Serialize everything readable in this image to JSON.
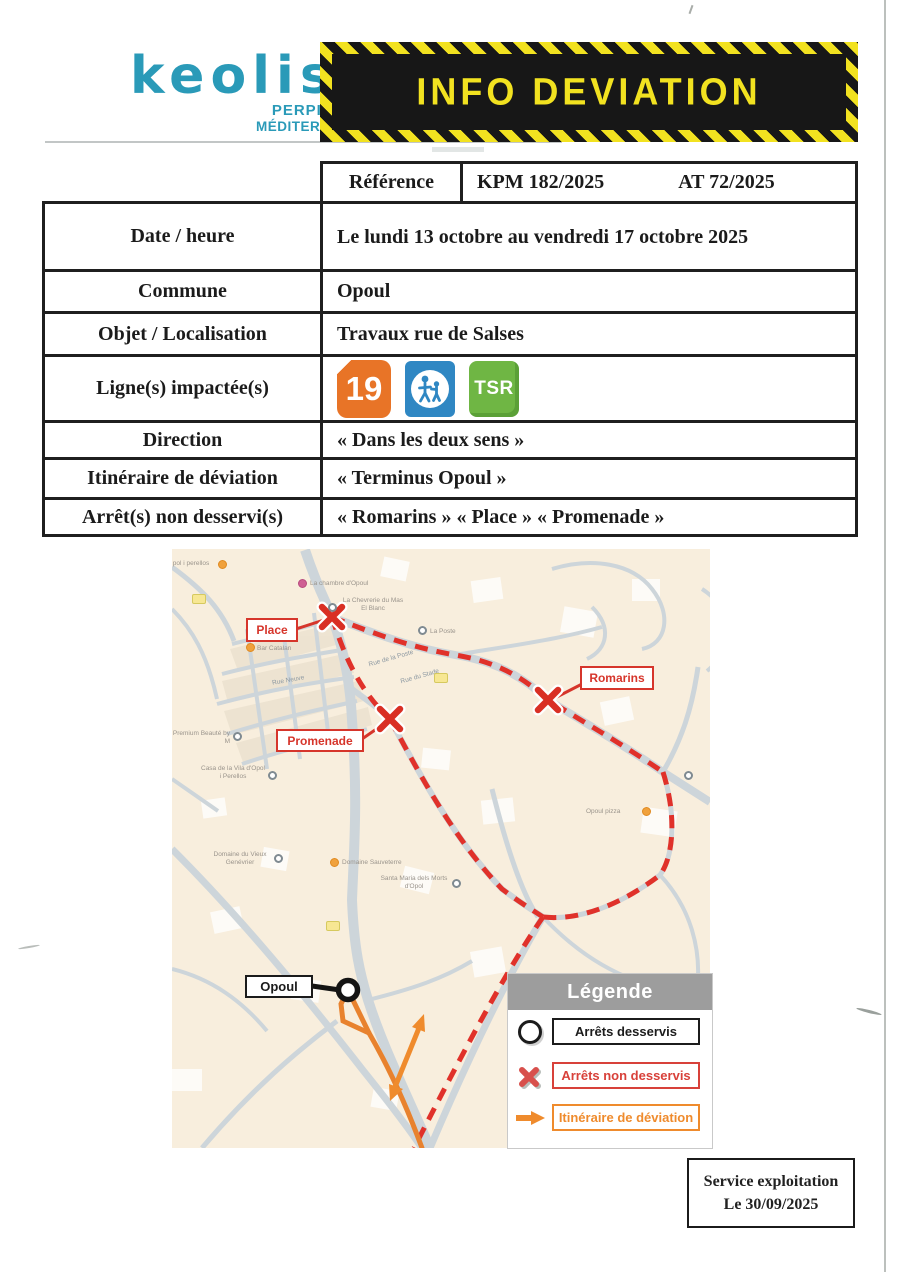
{
  "header": {
    "brand": "keolis",
    "brand_sub1": "PERPIGNAN",
    "brand_sub2": "MÉDITERRANÉE",
    "banner_title": "INFO DEVIATION",
    "banner_yellow": "#f2e220",
    "banner_black": "#171717"
  },
  "info_table": {
    "reference": {
      "label": "Référence",
      "value_left": "KPM 182/2025",
      "value_right": "AT 72/2025"
    },
    "date": {
      "label": "Date / heure",
      "value": "Le lundi 13 octobre au vendredi 17 octobre 2025",
      "color": "#e8241c"
    },
    "commune": {
      "label": "Commune",
      "value": "Opoul"
    },
    "objet": {
      "label": "Objet / Localisation",
      "value": "Travaux rue de Salses"
    },
    "lignes": {
      "label": "Ligne(s) impactée(s)"
    },
    "direction": {
      "label": "Direction",
      "value": "« Dans les deux sens »"
    },
    "itineraire": {
      "label": "Itinéraire de déviation",
      "value": "« Terminus Opoul »"
    },
    "arrets": {
      "label": "Arrêt(s) non desservi(s)",
      "value": "« Romarins » « Place » « Promenade »"
    },
    "line_badges": [
      {
        "id": "line-19",
        "text": "19",
        "color": "#e87427"
      },
      {
        "id": "line-scolaire",
        "icon": "school-children-icon",
        "color": "#2f87c3"
      },
      {
        "id": "line-tsr",
        "text": "TSR",
        "color": "#6fb644"
      }
    ]
  },
  "map": {
    "stop_labels": [
      {
        "name": "Place",
        "status": "non desservi"
      },
      {
        "name": "Promenade",
        "status": "non desservi"
      },
      {
        "name": "Romarins",
        "status": "non desservi"
      },
      {
        "name": "Opoul",
        "status": "desservi"
      }
    ],
    "streets": [
      "Rue Neuve",
      "Rue de la Poste",
      "Rue du Stade"
    ],
    "pois": [
      {
        "name": "pol i perellos"
      },
      {
        "name": "La chambre d'Opoul"
      },
      {
        "name": "La Chevrerie du Mas El Blanc"
      },
      {
        "name": "La Poste"
      },
      {
        "name": "Bar Catalan"
      },
      {
        "name": "Premium Beauté by M"
      },
      {
        "name": "Casa de la Vila d'Opol i Perellos"
      },
      {
        "name": "Opoul pizza"
      },
      {
        "name": "Domaine du Vieux Genévrier"
      },
      {
        "name": "Domaine Sauveterre"
      },
      {
        "name": "Santa Maria dels Morts d'Opol"
      }
    ],
    "legend": {
      "title": "Légende",
      "items": [
        {
          "icon": "circle",
          "label": "Arrêts desservis",
          "color": "#1c1c1c"
        },
        {
          "icon": "cross",
          "label": "Arrêts non desservis",
          "color": "#d8413a"
        },
        {
          "icon": "arrow",
          "label": "Itinéraire de déviation",
          "color": "#ef8b2d"
        }
      ]
    },
    "route_colors": {
      "deviation_orange": "#e8822e",
      "closed_red": "#e0312a"
    }
  },
  "footer": {
    "line1": "Service exploitation",
    "line2": "Le 30/09/2025"
  }
}
